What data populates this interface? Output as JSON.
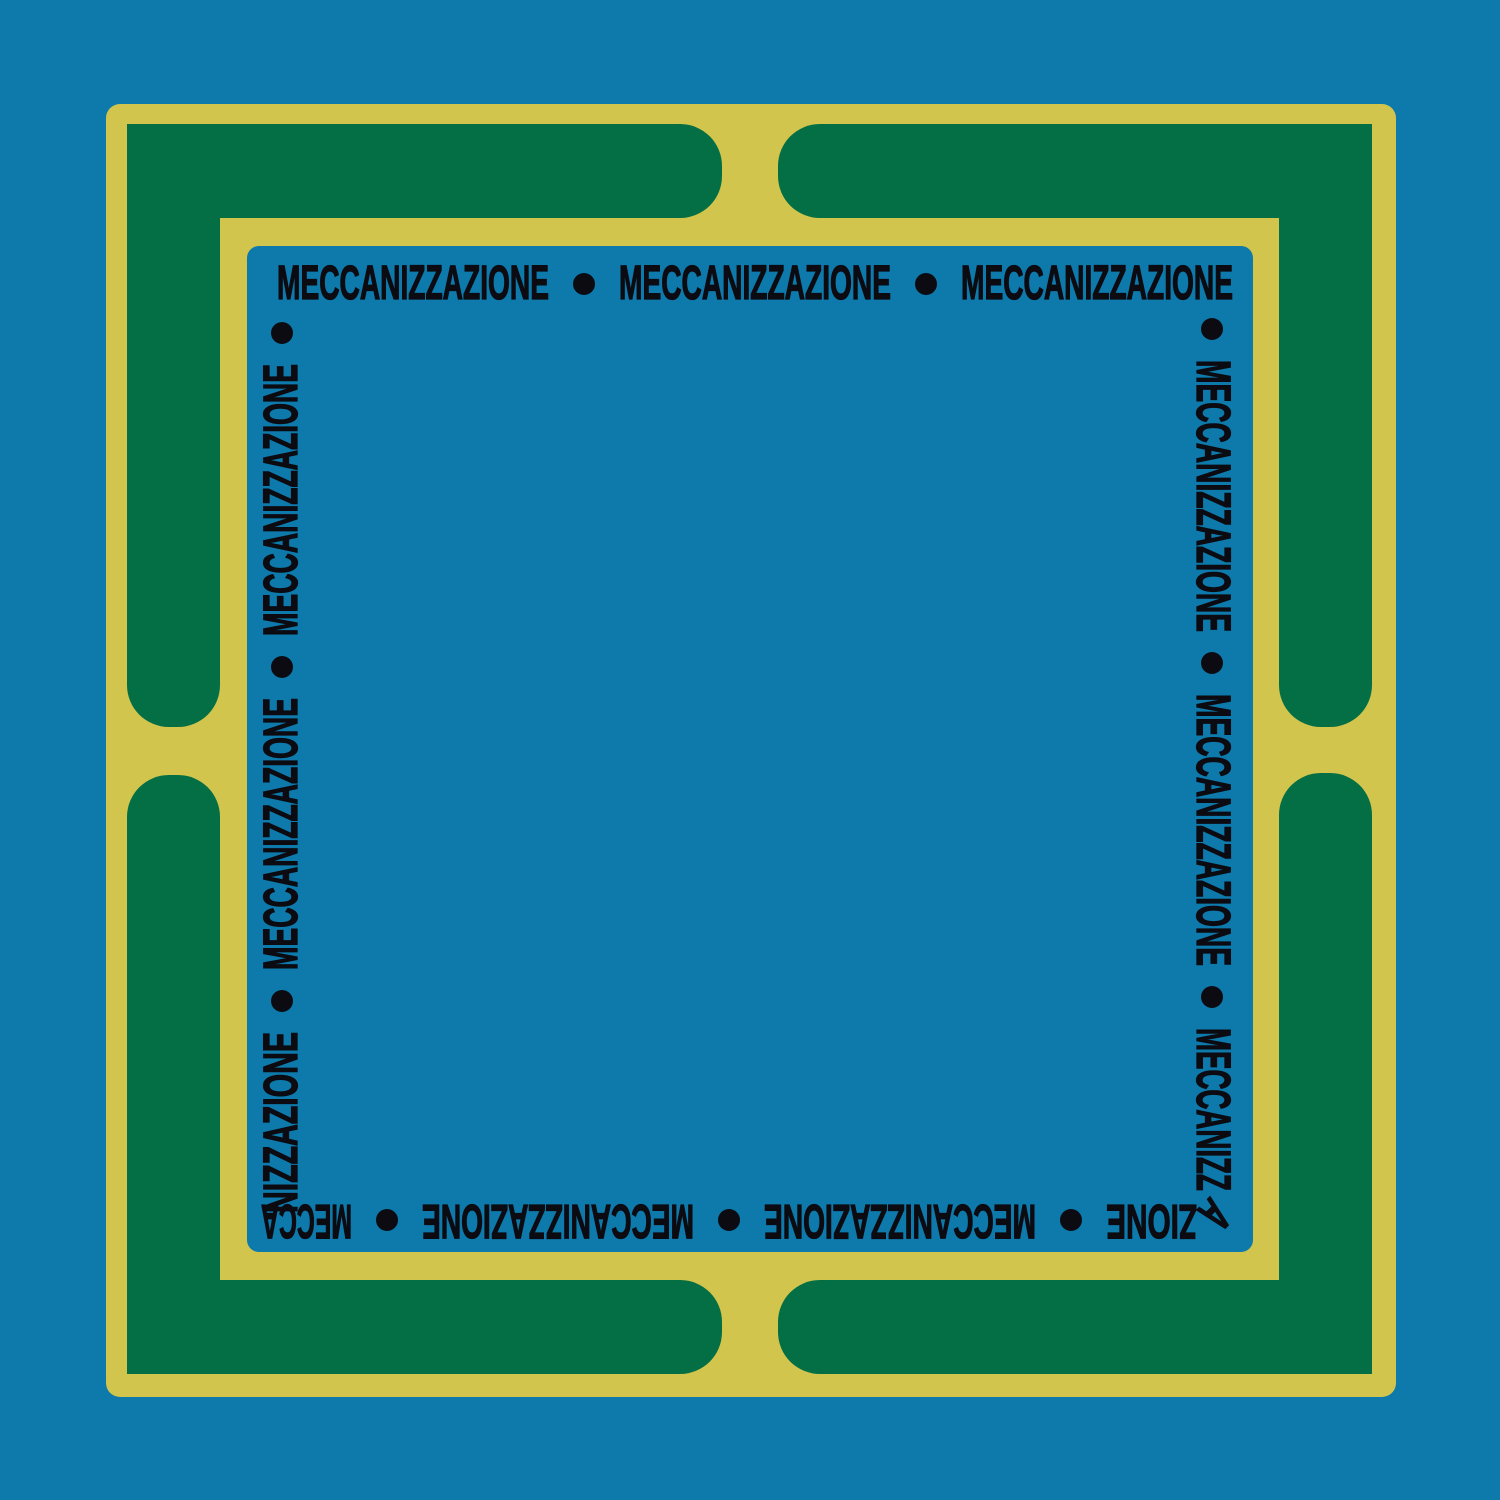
{
  "artwork": {
    "word": "MECCANIZZAZIONE",
    "separator": "•",
    "colors": {
      "background_blue": "#0E79AB",
      "frame_yellow": "#D2C54D",
      "panel_green": "#046F44",
      "text_black": "#0B0B11"
    },
    "border_text": {
      "top": {
        "items": [
          "MECCANIZZAZIONE",
          "•",
          "MECCANIZZAZIONE",
          "•",
          "MECCANIZZAZIONE"
        ]
      },
      "right": {
        "items": [
          "•",
          "MECCANIZZAZIONE",
          "•",
          "MECCANIZZAZIONE",
          "•",
          "MECCANIZZ"
        ]
      },
      "corner_bottom_right": "A",
      "bottom": {
        "items": [
          "ZIONE",
          "•",
          "MECCANIZZAZIONE",
          "•",
          "MECCANIZZAZIONE",
          "•",
          "MECCA"
        ]
      },
      "left": {
        "items": [
          "NIZZAZIONE",
          "•",
          "MECCANIZZAZIONE",
          "•",
          "MECCANIZZAZIONE",
          "•"
        ]
      }
    }
  }
}
